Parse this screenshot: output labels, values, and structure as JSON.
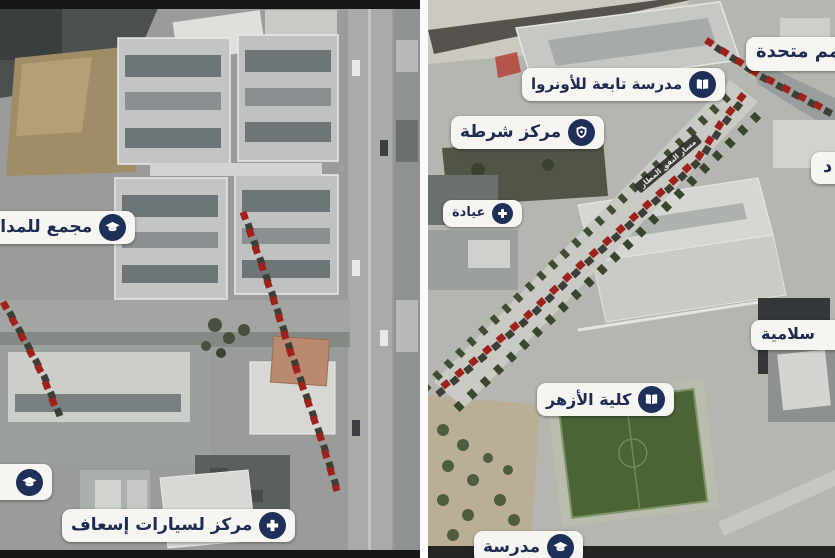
{
  "colors": {
    "pill_background": "#f6f5f1",
    "label_navy": "#1e2c52",
    "icon_circle_navy": "#1e3057",
    "route_red": "#9e221b",
    "route_shadow": "#3c3f35",
    "marked_building_red": "#b5473c",
    "divider_white": "#fafaf8"
  },
  "left_panel": {
    "labels": [
      {
        "text": "مجمع للمدارس",
        "icon": "graduation-cap-icon"
      },
      {
        "text": "",
        "icon": "graduation-cap-icon"
      },
      {
        "text": "مركز لسيارات إسعاف",
        "icon": "medical-cross-icon"
      }
    ]
  },
  "right_panel": {
    "labels": [
      {
        "text": "مدرسة تابعة للأونروا",
        "icon": "book-icon"
      },
      {
        "text": "مركز شرطة",
        "icon": "police-badge-icon"
      },
      {
        "text": "عيادة",
        "icon": "medical-cross-icon"
      },
      {
        "text": "كلية الأزهر",
        "icon": "book-icon"
      },
      {
        "text": "مدرسة",
        "icon": "graduation-cap-icon"
      },
      {
        "text": "مم متحدة",
        "icon": null
      },
      {
        "text": "د",
        "icon": null
      },
      {
        "text": "سلامية",
        "icon": null
      }
    ],
    "street_banner": "مسار النفق المطار"
  }
}
